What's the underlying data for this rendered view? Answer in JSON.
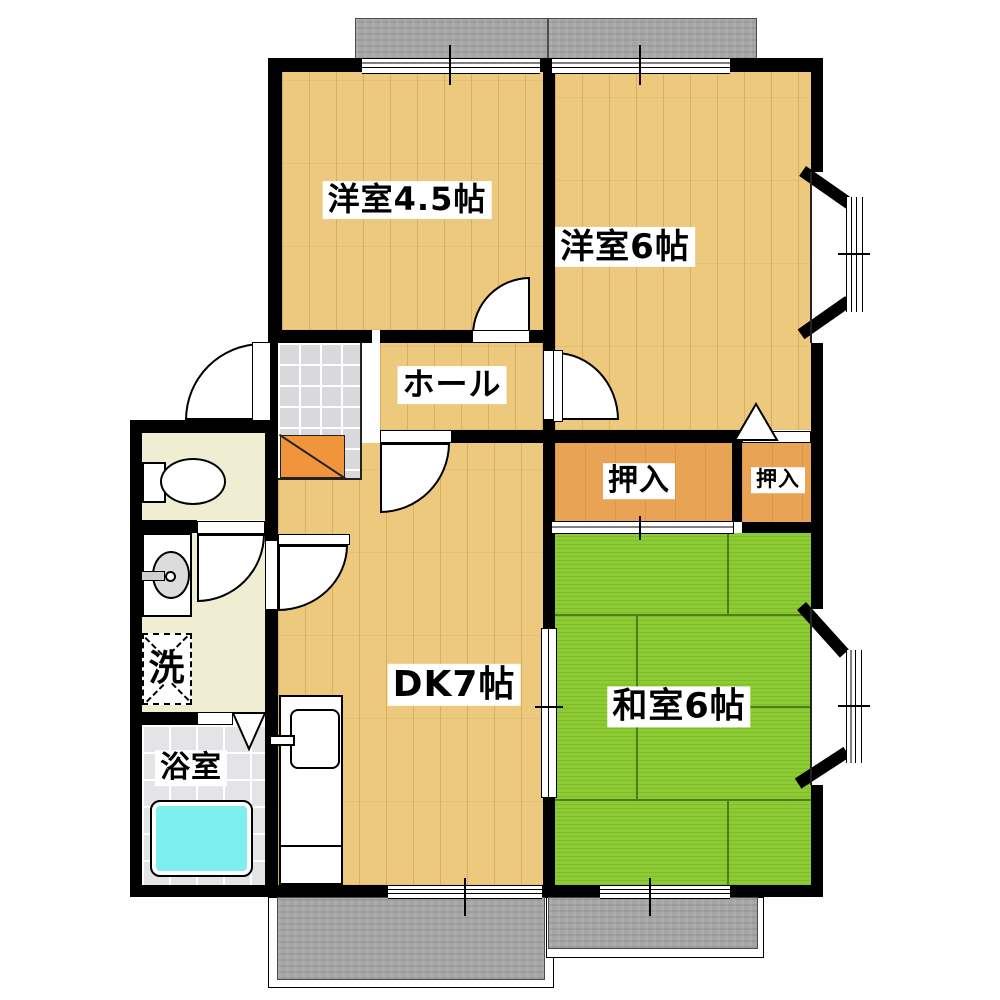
{
  "plan": {
    "type": "apartment-floor-plan",
    "rooms": {
      "western_room_4_5": {
        "label": "洋室4.5帖"
      },
      "western_room_6": {
        "label": "洋室6帖"
      },
      "hall": {
        "label": "ホール"
      },
      "closet_large": {
        "label": "押入"
      },
      "closet_small": {
        "label": "押入"
      },
      "dining_kitchen": {
        "label": "DK7帖"
      },
      "japanese_room_6": {
        "label": "和室6帖"
      },
      "laundry": {
        "label": "洗"
      },
      "bathroom": {
        "label": "浴室"
      }
    },
    "colors": {
      "wall": "#000000",
      "wood_floor": "#EDC97E",
      "tatami": "#8CCB33",
      "closet": "#E9A355",
      "entry_step": "#F0953C",
      "entry_tile": "#D9D9DC",
      "utility_floor": "#EFEDD2",
      "bath_floor": "#E4E4E7",
      "bathtub": "#7EEFEF",
      "balcony": "#A6A6A6"
    }
  }
}
